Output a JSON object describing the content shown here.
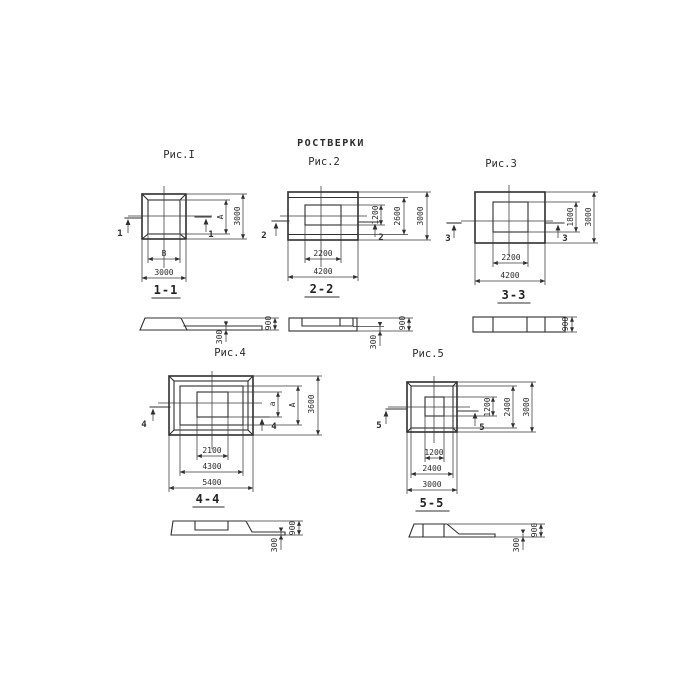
{
  "title": "РОСТВЕРКИ",
  "colors": {
    "ink": "#2f2f2f",
    "paper": "#ffffff"
  },
  "figures": [
    {
      "label": "Рис.I",
      "cut": "1",
      "section_label": "1-1",
      "plan_dims": {
        "inner_width": "В",
        "outer_width": "3000",
        "inner_height": "А",
        "outer_height": "3000"
      },
      "section_dims": {
        "slab": "300",
        "total": "900"
      }
    },
    {
      "label": "Рис.2",
      "cut": "2",
      "section_label": "2-2",
      "plan_dims": {
        "inner_width": "2200",
        "outer_width": "4200",
        "inner_height": "1200",
        "mid_height": "2600",
        "outer_height": "3000"
      },
      "section_dims": {
        "slab": "300",
        "total": "900"
      }
    },
    {
      "label": "Рис.3",
      "cut": "3",
      "section_label": "3-3",
      "plan_dims": {
        "inner_width": "2200",
        "outer_width": "4200",
        "inner_height": "1800",
        "outer_height": "3000"
      },
      "section_dims": {
        "total": "900"
      }
    },
    {
      "label": "Рис.4",
      "cut": "4",
      "section_label": "4-4",
      "plan_dims": {
        "inner_width": "2100",
        "mid_width": "4300",
        "outer_width": "5400",
        "inner_height": "а",
        "mid_height": "А",
        "outer_height": "3600"
      },
      "section_dims": {
        "slab": "300",
        "total": "900"
      }
    },
    {
      "label": "Рис.5",
      "cut": "5",
      "section_label": "5-5",
      "plan_dims": {
        "inner_width": "1200",
        "mid_width": "2400",
        "outer_width": "3000",
        "inner_height": "1200",
        "mid_height": "2400",
        "outer_height": "3000"
      },
      "section_dims": {
        "slab": "300",
        "total": "900"
      }
    }
  ]
}
